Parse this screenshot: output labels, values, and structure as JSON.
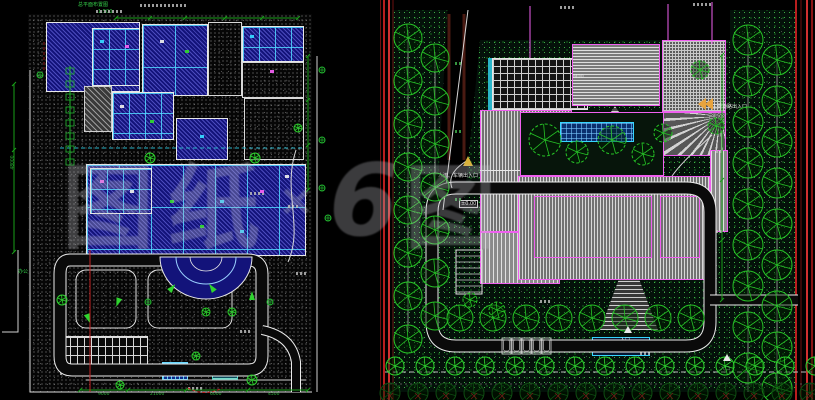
{
  "watermark": {
    "text_left": "图纸",
    "separator": "×",
    "logo_glyph": "6",
    "text_right": "图"
  },
  "left_plan": {
    "title_note": "总平面布置图",
    "scale_note": "1:500",
    "side_label": "办公",
    "dims_bottom": [
      "9000",
      "21000",
      "6000",
      "4500"
    ],
    "dim_left": "48000"
  },
  "right_plan": {
    "label_entrance_secondary": "人流、车辆出入口",
    "label_entrance_main": "主要道路出入口",
    "label_entrance_south": "入口",
    "label_entrance_southeast": "入口",
    "label_elevation": "±0.00",
    "label_room": "M00"
  },
  "colors": {
    "tree_green": "#27c427",
    "outline_magenta": "#f060f0",
    "building_blue": "#13137a",
    "border_red": "#c22424",
    "cad_cyan": "#35d5ff"
  }
}
